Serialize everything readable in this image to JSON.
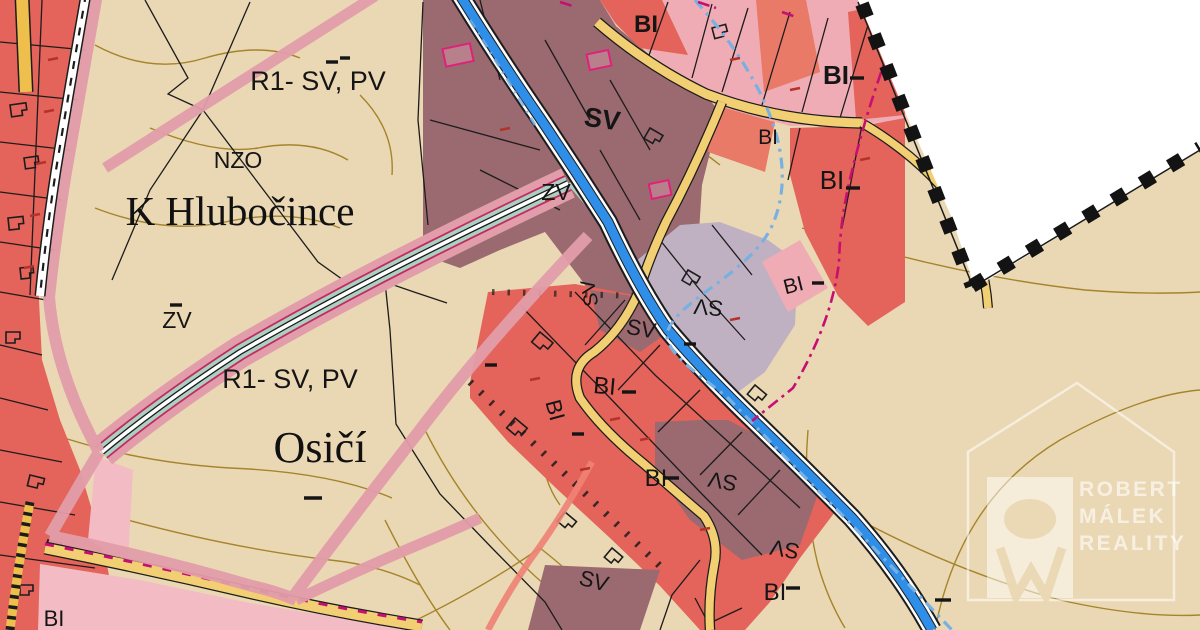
{
  "palette": {
    "beige": "#ead8b4",
    "maroon": "#9a6a70",
    "lavender": "#c0b1c2",
    "red": "#e4635a",
    "redLight": "#ea7a68",
    "pinkParcel": "#f0acb4",
    "pinkLight": "#f3bcc4",
    "pinkBand": "#e29daa",
    "salmon": "#ee8274",
    "crimson": "#c22a62",
    "teal": "#abcfc0",
    "yellowRoad": "#f2cf72",
    "yellowDark": "#eebf4d",
    "blueRoad": "#2e8ee8",
    "lightBlue": "#79b0e2",
    "magenta": "#c50f72",
    "contour": "#9e7b1d",
    "blackLine": "#1c1c1c",
    "whiteZone": "#ffffff"
  },
  "map": {
    "zone_labels": [
      {
        "text": "R1- SV, PV",
        "x": 318,
        "y": 90,
        "size": 27,
        "font": "sans",
        "rot": 0,
        "bold": false
      },
      {
        "text": "NZO",
        "x": 238,
        "y": 168,
        "size": 23,
        "font": "sans",
        "rot": 0,
        "bold": false
      },
      {
        "text": "K Hlubočince",
        "x": 240,
        "y": 225,
        "size": 41,
        "font": "serif",
        "rot": 0,
        "bold": false
      },
      {
        "text": "ZV",
        "x": 556,
        "y": 200,
        "size": 23,
        "font": "sans",
        "rot": 0,
        "bold": false
      },
      {
        "text": "ZV",
        "x": 177,
        "y": 328,
        "size": 23,
        "font": "sans",
        "rot": 0,
        "bold": false
      },
      {
        "text": "R1- SV, PV",
        "x": 290,
        "y": 388,
        "size": 27,
        "font": "sans",
        "rot": 0,
        "bold": false
      },
      {
        "text": "Osičí",
        "x": 320,
        "y": 462,
        "size": 44,
        "font": "serif",
        "rot": 0,
        "bold": false
      },
      {
        "text": "SV",
        "x": 601,
        "y": 128,
        "size": 27,
        "font": "sans",
        "rot": 8,
        "bold": true
      },
      {
        "text": "BI",
        "x": 646,
        "y": 32,
        "size": 24,
        "font": "sans",
        "rot": 0,
        "bold": true
      },
      {
        "text": "BI",
        "x": 836,
        "y": 84,
        "size": 26,
        "font": "sans",
        "rot": 0,
        "bold": true
      },
      {
        "text": "BI",
        "x": 768,
        "y": 144,
        "size": 21,
        "font": "sans",
        "rot": 0,
        "bold": false
      },
      {
        "text": "BI",
        "x": 832,
        "y": 189,
        "size": 26,
        "font": "sans",
        "rot": 0,
        "bold": false
      },
      {
        "text": "BI",
        "x": 795,
        "y": 292,
        "size": 21,
        "font": "sans",
        "rot": -14,
        "bold": false
      },
      {
        "text": "SV",
        "x": 596,
        "y": 292,
        "size": 20,
        "font": "sans",
        "rot": -100,
        "bold": false
      },
      {
        "text": "SV",
        "x": 640,
        "y": 336,
        "size": 22,
        "font": "sans",
        "rot": 10,
        "bold": false
      },
      {
        "text": "SV",
        "x": 709,
        "y": 300,
        "size": 22,
        "font": "sans",
        "rot": 185,
        "bold": false
      },
      {
        "text": "BI",
        "x": 604,
        "y": 394,
        "size": 24,
        "font": "sans",
        "rot": 5,
        "bold": false
      },
      {
        "text": "BI",
        "x": 548,
        "y": 412,
        "size": 22,
        "font": "sans",
        "rot": 75,
        "bold": false
      },
      {
        "text": "BI",
        "x": 656,
        "y": 486,
        "size": 24,
        "font": "sans",
        "rot": 0,
        "bold": false
      },
      {
        "text": "SV",
        "x": 724,
        "y": 474,
        "size": 22,
        "font": "sans",
        "rot": 190,
        "bold": false
      },
      {
        "text": "SV",
        "x": 786,
        "y": 542,
        "size": 22,
        "font": "sans",
        "rot": 190,
        "bold": false
      },
      {
        "text": "BI",
        "x": 775,
        "y": 600,
        "size": 24,
        "font": "sans",
        "rot": 0,
        "bold": false
      },
      {
        "text": "SV",
        "x": 592,
        "y": 588,
        "size": 22,
        "font": "sans",
        "rot": 15,
        "bold": false
      },
      {
        "text": "BI",
        "x": 54,
        "y": 626,
        "size": 22,
        "font": "sans",
        "rot": 0,
        "bold": false
      }
    ],
    "watermark": {
      "lines": [
        "ROBERT",
        "MÁLEK",
        "REALITY"
      ]
    }
  }
}
